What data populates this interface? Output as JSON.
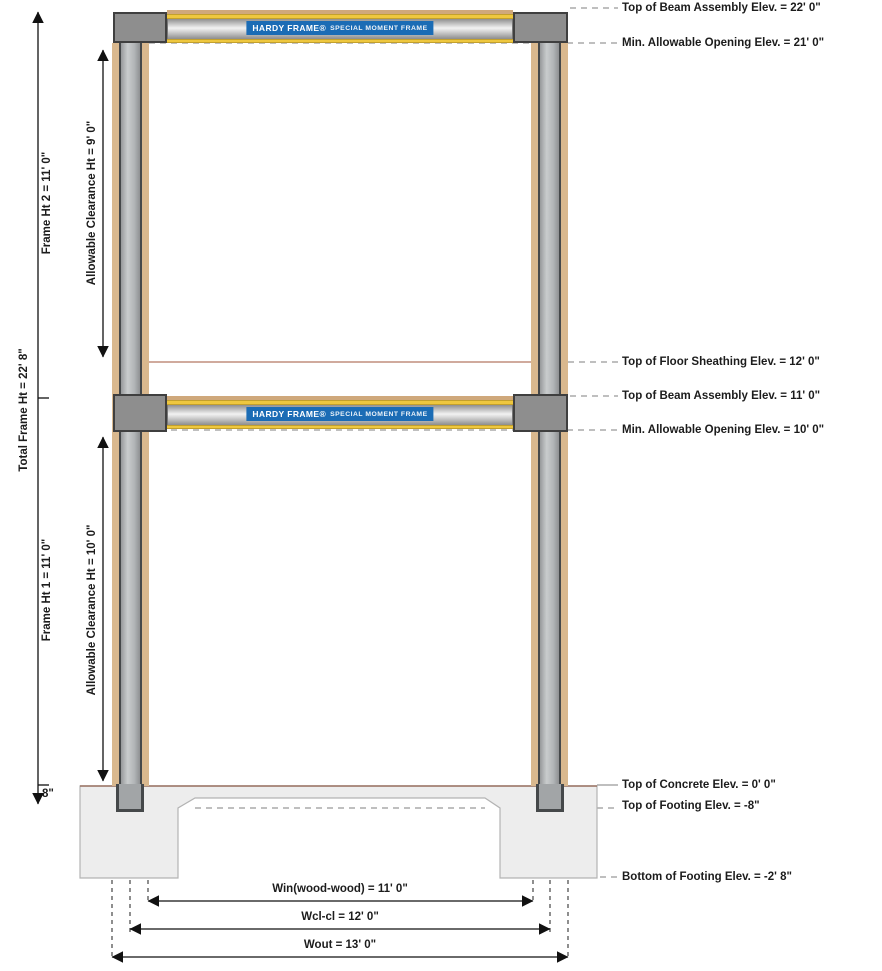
{
  "diagram": {
    "beam_badge": {
      "brand": "HARDY FRAME®",
      "product": "SPECIAL MOMENT FRAME"
    },
    "left_dims": {
      "total_frame_ht": "Total Frame Ht = 22' 8\"",
      "frame_ht_2": "Frame Ht 2 = 11' 0\"",
      "frame_ht_1": "Frame Ht 1 = 11' 0\"",
      "clearance_ht_2": "Allowable Clearance Ht = 9' 0\"",
      "clearance_ht_1": "Allowable Clearance Ht = 10' 0\"",
      "embed_depth": "8\""
    },
    "right_callouts": [
      {
        "text": "Top of Beam Assembly Elev. = 22' 0\""
      },
      {
        "text": "Min. Allowable Opening Elev. = 21' 0\""
      },
      {
        "text": "Top of Floor Sheathing Elev. = 12' 0\""
      },
      {
        "text": "Top of Beam Assembly Elev. = 11' 0\""
      },
      {
        "text": "Min. Allowable Opening Elev. = 10' 0\""
      },
      {
        "text": "Top of Concrete Elev. = 0' 0\""
      },
      {
        "text": "Top of Footing Elev. = -8\""
      },
      {
        "text": "Bottom of Footing Elev. = -2' 8\""
      }
    ],
    "bottom_dims": {
      "win": "Win(wood-wood) = 11' 0\"",
      "wcl": "Wcl-cl = 12' 0\"",
      "wout": "Wout = 13' 0\""
    },
    "colors": {
      "badge_blue": "#1b6cb5",
      "steel_gray": "#b5b8ba",
      "wood_tan": "#d9b88e",
      "flange_yellow": "#eec73f",
      "concrete_gray": "#ededed",
      "connection_gray": "#8e8e8e",
      "leader_gray": "#999999",
      "sheathing_brown": "#c08d7d"
    }
  }
}
